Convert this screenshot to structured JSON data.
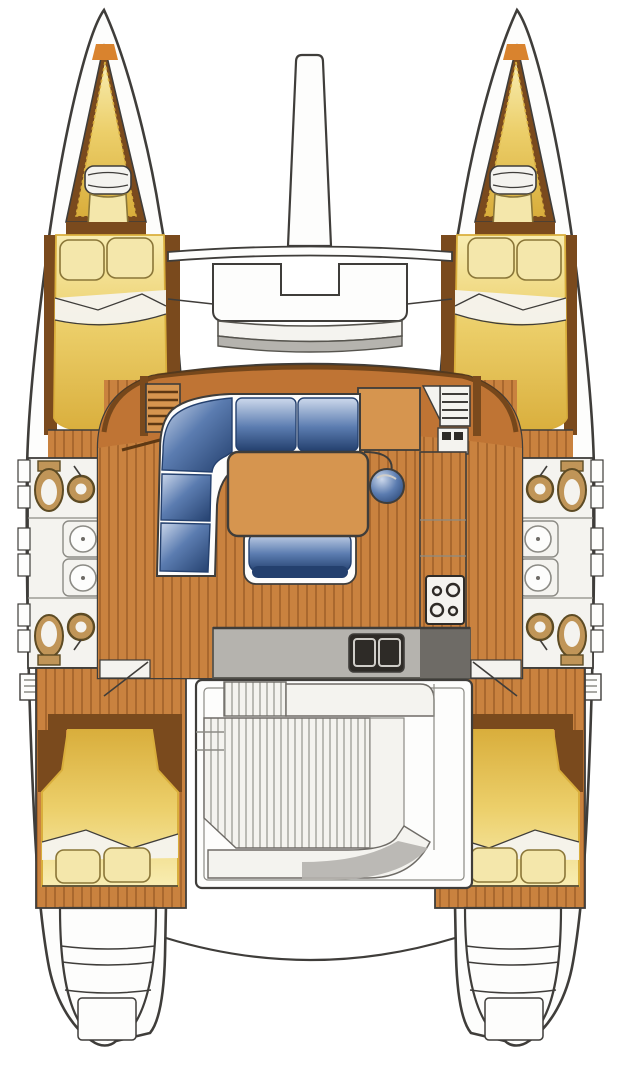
{
  "diagram": {
    "type": "catamaran-floor-plan",
    "view": "top-down interior layout drawing",
    "text": [],
    "areas": [
      {
        "id": "port-forepeak",
        "glyph": "forepeak-berth"
      },
      {
        "id": "port-forward-cabin",
        "glyph": "double-berth-with-pillows"
      },
      {
        "id": "port-heads",
        "glyph": "two-toilets-two-basins-two-showers"
      },
      {
        "id": "port-aft-cabin",
        "glyph": "double-berth-with-pillows"
      },
      {
        "id": "starboard-forepeak",
        "glyph": "forepeak-berth"
      },
      {
        "id": "starboard-forward-cabin",
        "glyph": "double-berth-with-pillows"
      },
      {
        "id": "starboard-heads",
        "glyph": "two-toilets-two-basins-two-showers"
      },
      {
        "id": "starboard-aft-cabin",
        "glyph": "double-berth-with-pillows"
      },
      {
        "id": "saloon",
        "glyph": "L-shaped-settee-table-stool"
      },
      {
        "id": "galley",
        "glyph": "double-sink-and-four-burner-stove"
      },
      {
        "id": "cockpit",
        "glyph": "teak-slats-with-benches"
      },
      {
        "id": "foredeck",
        "glyph": "bowsprit-beam-and-curved-seat"
      },
      {
        "id": "transoms",
        "glyph": "swim-steps-both-hulls"
      }
    ],
    "counts": {
      "double_berths": 4,
      "forepeak_berths": 2,
      "toilets": 4,
      "basins": 4,
      "showers": 4,
      "stove_burners": 4,
      "sink_basins": 2
    }
  },
  "colors": {
    "canvas": "#ffffff",
    "line": "#3f3d3a",
    "line_soft": "#8c8b85",
    "wood": "#c9823f",
    "wood_band": "#bf7434",
    "wood_light": "#d6954f",
    "plank": "#a1622a",
    "trim": "#7a4a1d",
    "trim_dark": "#5d3813",
    "accent_orange": "#d9832e",
    "bed_hi": "#f8edb2",
    "bed_mid": "#eccf6a",
    "bed_low": "#d9ae3c",
    "pillow": "#f4e7ab",
    "pillow_line": "#8a7638",
    "white": "#fdfdfc",
    "white_soft": "#f4f3ef",
    "gray": "#b5b3ae",
    "gray_dark": "#6e6b66",
    "counter_dark": "#56544e",
    "sink_dark": "#2e2b27",
    "steel": "#cfcdc8",
    "blue_hi": "#cdd9ec",
    "blue_mid": "#5b7cb0",
    "blue_low": "#24406e",
    "fixture_tan": "#c09558",
    "fixture_line": "#5d4b24"
  }
}
